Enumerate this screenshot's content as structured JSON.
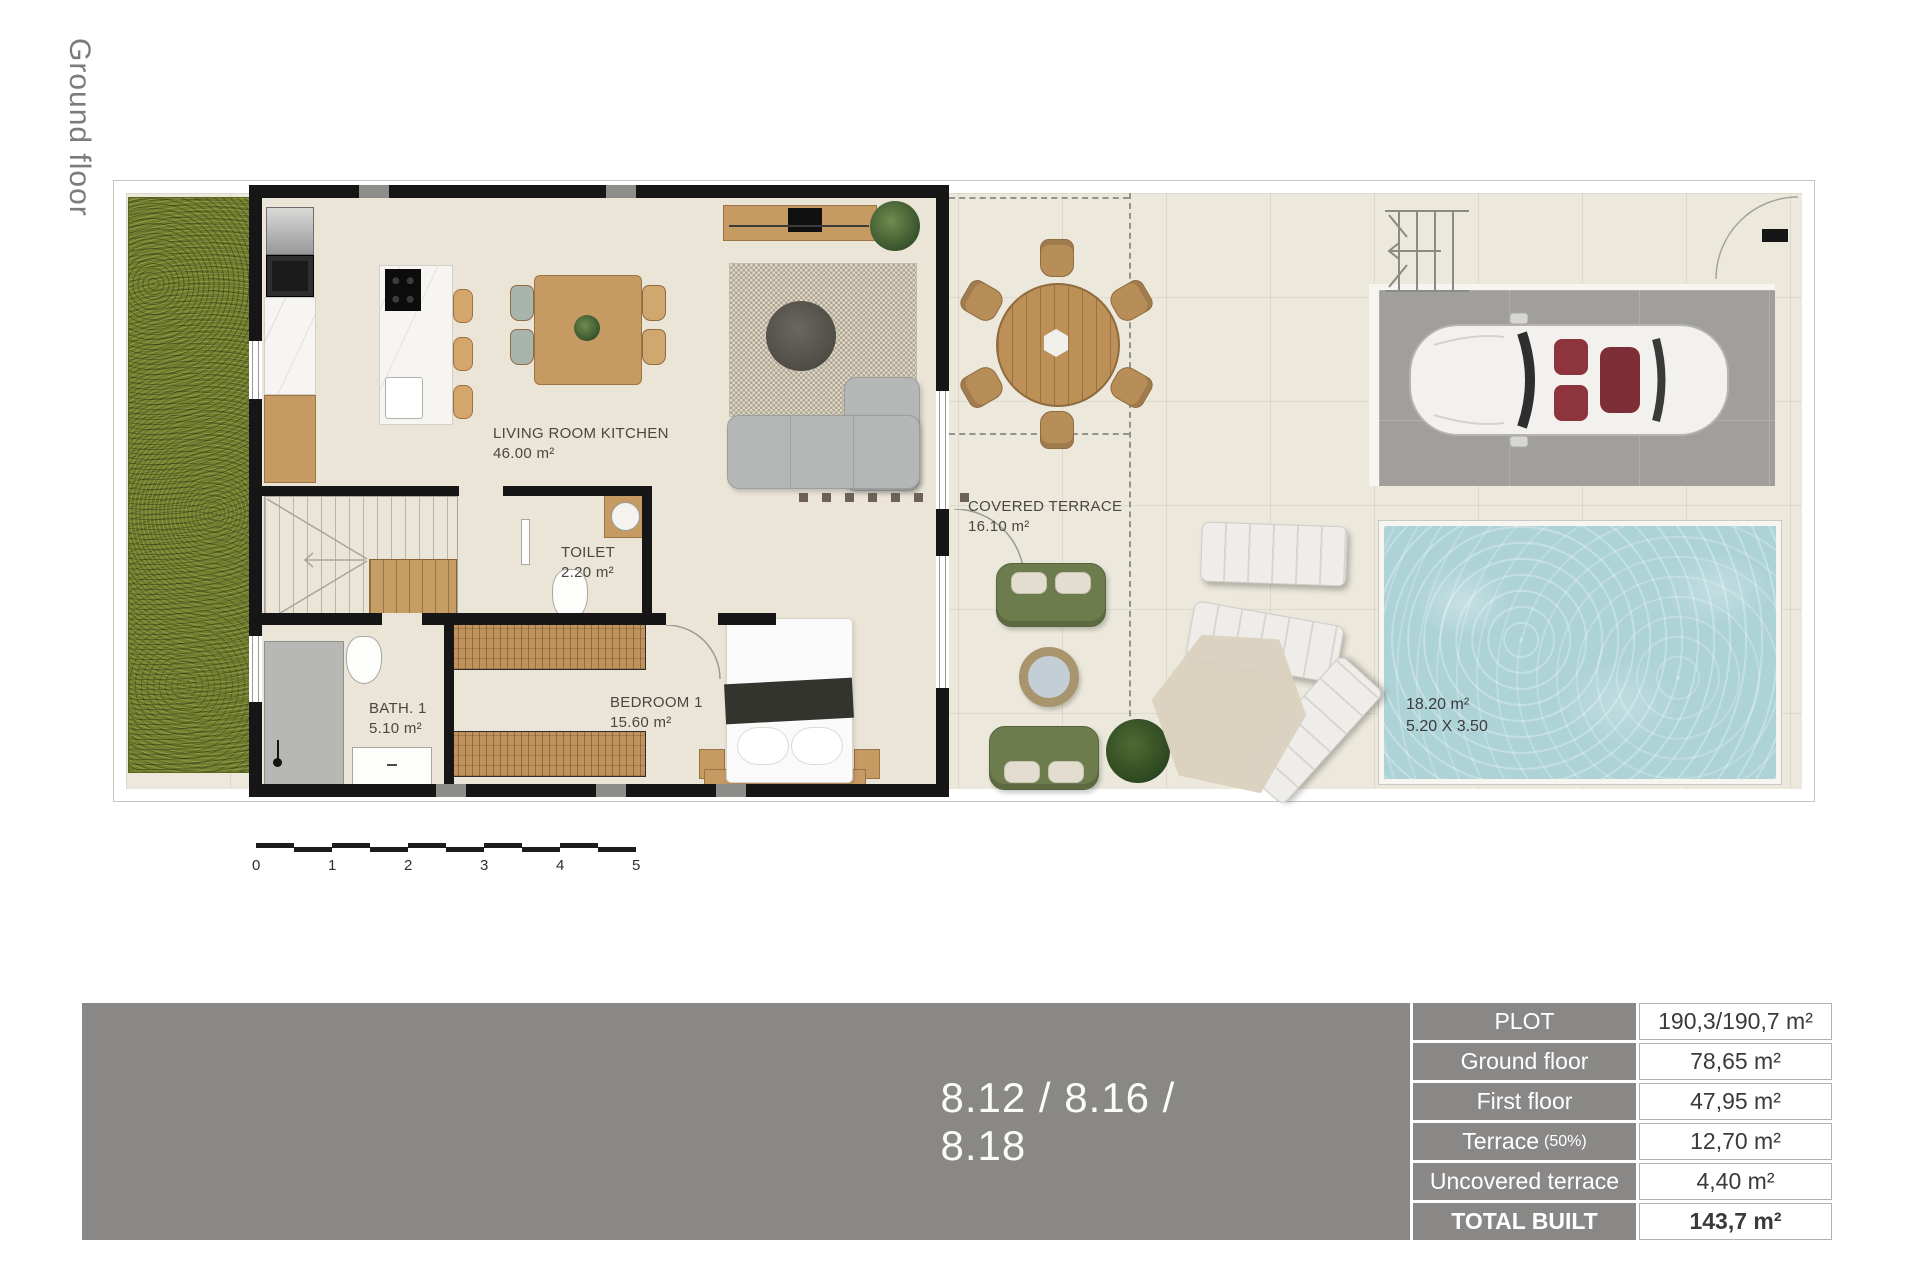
{
  "page": {
    "floor_label": "Ground floor"
  },
  "plan": {
    "rooms": [
      {
        "name": "LIVING ROOM KITCHEN",
        "area": "46.00 m²"
      },
      {
        "name": "TOILET",
        "area": "2.20 m²"
      },
      {
        "name": "BATH. 1",
        "area": "5.10 m²"
      },
      {
        "name": "BEDROOM 1",
        "area": "15.60 m²"
      },
      {
        "name": "COVERED TERRACE",
        "area": "16.10 m²"
      }
    ],
    "pool": {
      "area": "18.20 m²",
      "dimensions": "5.20 X 3.50"
    },
    "scale_ticks": [
      "0",
      "1",
      "2",
      "3",
      "4",
      "5"
    ]
  },
  "banner": {
    "units_label": "8.12 / 8.16 / 8.18"
  },
  "areas_table": {
    "rows": [
      {
        "label": "PLOT",
        "value": "190,3/190,7 m²"
      },
      {
        "label": "Ground floor",
        "value": "78,65 m²"
      },
      {
        "label": "First floor",
        "value": "47,95 m²"
      },
      {
        "label": "Terrace",
        "label_note": "(50%)",
        "value": "12,70 m²"
      },
      {
        "label": "Uncovered terrace",
        "value": "4,40 m²"
      },
      {
        "label": "TOTAL BUILT",
        "value": "143,7 m²"
      }
    ]
  },
  "colors": {
    "banner_gray": "#8a8887",
    "wall_black": "#161616",
    "grass_green": "#707d2d",
    "pool_blue": "#aed3d7",
    "wood": "#c59a63",
    "sofa_olive": "#6d7c4d",
    "floor_beige": "#ece8dc",
    "driveway_gray": "#a09f9b"
  }
}
